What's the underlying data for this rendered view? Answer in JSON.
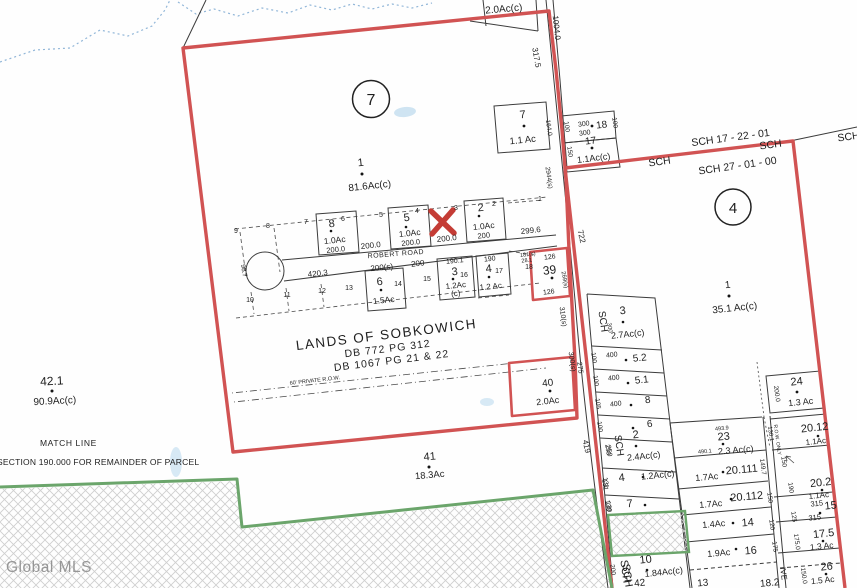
{
  "watermark": "Global MLS",
  "annotations": {
    "match_line": "MATCH LINE",
    "section_note": "SECTION 190.000 FOR REMAINDER OF PARCEL",
    "lands_title": "LANDS OF SOBKOWICH",
    "deed1": "DB  772    PG  312",
    "deed2": "DB  1067    PG  21 & 22",
    "private_row": "60' PRIVATE    R.O.W.",
    "row_only": "R.O.W. ONLY"
  },
  "district": {
    "top_line": "SCH 17 - 22 - 01",
    "main_line": "SCH 27 - 01 - 00",
    "sch_a": "SCH",
    "sch_b": "SCH",
    "sch_edge": "SCH",
    "sch_bottom": "SCH"
  },
  "sections": {
    "left": "7",
    "right": "4"
  },
  "parcels": {
    "left_main": {
      "num": "1",
      "ac": "81.6Ac(c)"
    },
    "right_main": {
      "num": "1",
      "ac": "35.1 Ac(c)"
    },
    "p42_1": {
      "num": "42.1",
      "ac": "90.9Ac(c)"
    },
    "p41": {
      "num": "41",
      "ac": "18.3Ac"
    },
    "p40": {
      "num": "40",
      "ac": "2.0Ac"
    },
    "p39": {
      "num": "39",
      "d_top": "126",
      "d_side": "269(s)",
      "d_bottom": "126"
    },
    "p7_top": {
      "num": "7",
      "ac": "1.1 Ac",
      "d_side": "164.0"
    },
    "p18_top": {
      "num": "18",
      "d_top": "300",
      "d_bottom": "300",
      "d_left": "100",
      "d_right": "100"
    },
    "p17_top": {
      "num": "17",
      "ac": "1.1Ac(c)",
      "d_left": "150"
    },
    "p2_strip": {
      "ac": "2.0Ac(c)"
    }
  },
  "robert_road": {
    "name": "ROBERT ROAD",
    "cul_de_sac_dim": "98.7",
    "ticks_top": [
      "9",
      "8",
      "7",
      "6",
      "5",
      "4",
      "3",
      "2",
      "1"
    ],
    "ticks_bottom": [
      "10",
      "11",
      "12",
      "13",
      "14",
      "15",
      "16",
      "17",
      "18"
    ],
    "lot8": {
      "num": "8",
      "ac": "1.0Ac",
      "dim": "200.0"
    },
    "lot5": {
      "num": "5",
      "ac": "1.0Ac",
      "dim": "200.0"
    },
    "lot2": {
      "num": "2",
      "ac": "1.0Ac",
      "dim": "200"
    },
    "gap1": "200.0",
    "gap2": "200.0",
    "gap3": "299.6",
    "lot6": {
      "num": "6",
      "ac": "1.5Ac",
      "dim": "200(s)"
    },
    "lot3": {
      "num": "3",
      "ac": "1.2Ac",
      "ac2": "(c)",
      "dim": "190.1"
    },
    "lot4": {
      "num": "4",
      "ac": "1.2 Ac",
      "dim": "190"
    },
    "below_dim1": "420.3",
    "below_dim2": "200",
    "right_dim1": "181(s)",
    "right_dim2": "28.1"
  },
  "east_col": {
    "p3": {
      "num": "3",
      "ac": "2.7Ac(c)",
      "sch": "SCH",
      "d": "300"
    },
    "p52": {
      "num": "5.2",
      "w": "400",
      "l": "100"
    },
    "p51": {
      "num": "5.1",
      "w": "400",
      "l": "100"
    },
    "p8": {
      "num": "8",
      "w": "400",
      "l": "105"
    },
    "p6": {
      "num": "6",
      "l": "100"
    },
    "p2": {
      "num": "2",
      "ac": "2.4Ac(c)",
      "sch": "SCH",
      "l": "250"
    },
    "p4": {
      "num": "4",
      "ac": "1.2Ac(c)",
      "l": "131"
    },
    "p7": {
      "num": "7",
      "l": "130"
    },
    "p10": {
      "num": "10",
      "ac": "1.84Ac(c)",
      "sch": "SCH",
      "l": "200",
      "frag": "42"
    }
  },
  "mid_col": {
    "p23": {
      "num": "23",
      "ac": "2.3 Ac(c)",
      "d_top": "493.9",
      "d_left": "490.1"
    },
    "p20111": {
      "num": "20.111",
      "ac": "1.7Ac"
    },
    "p20112": {
      "num": "20.112",
      "ac": "1.7Ac",
      "r": "150"
    },
    "p14": {
      "num": "14",
      "ac": "1.4Ac",
      "r": "120"
    },
    "p16": {
      "num": "16",
      "ac": "1.9Ac",
      "r": "175"
    },
    "frag1": "13",
    "frag2": "18.2"
  },
  "right_col": {
    "p24": {
      "num": "24",
      "ac": "1.3 Ac",
      "l": "200.0"
    },
    "p2012": {
      "num": "20.12",
      "ac": "1.1Ac",
      "l": "150"
    },
    "p202": {
      "num": "20.2",
      "ac": "1.1Ac",
      "l": "190"
    },
    "p15": {
      "num": "15",
      "d_top": "315",
      "d_bottom": "315",
      "l": "125"
    },
    "p175": {
      "num": "17.5",
      "ac": "1.3 Ac",
      "l": "175.0"
    },
    "p26": {
      "num": "26",
      "ac": "1.5 Ac",
      "l": "150.0"
    },
    "row_dims": {
      "d1": "130.1",
      "d2": "149.7"
    }
  },
  "road_dims": {
    "d1004": "1004.0",
    "d317": "317.5",
    "d2944": "2944(s)",
    "d722": "722",
    "d310": "310(s)",
    "d300": "300(s)",
    "d275": "275",
    "d419": "419",
    "d131": "131",
    "d130": "130",
    "d250": "250",
    "drive_frag": "IVE"
  }
}
